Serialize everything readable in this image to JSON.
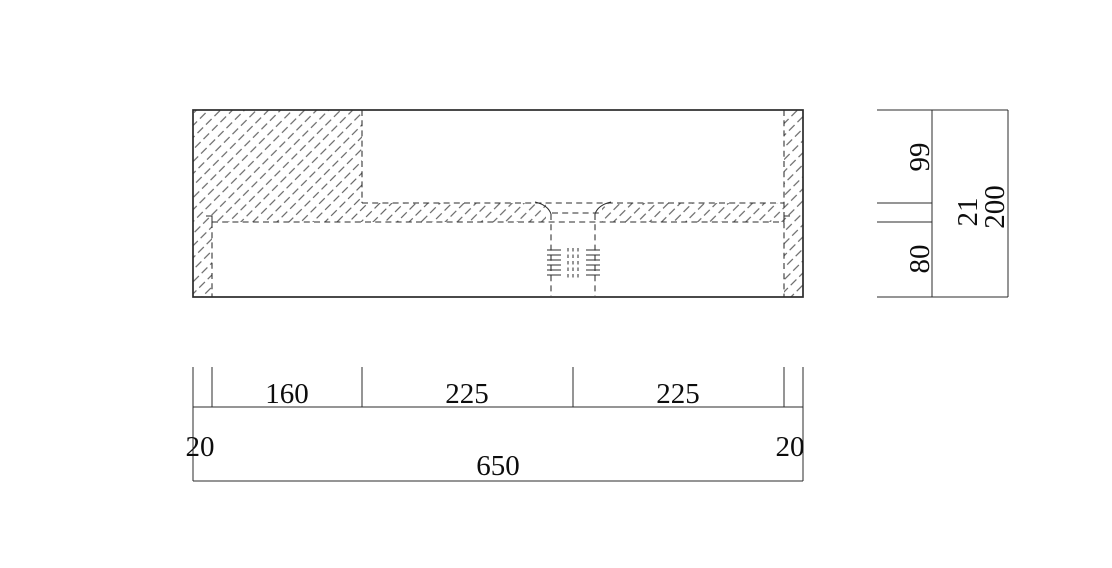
{
  "colors": {
    "background": "#ffffff",
    "line": "#2b2b2b",
    "hatch": "#4a4a4a",
    "text": "#0d0d0d"
  },
  "section_dims": {
    "upper_height": "99",
    "slab_thickness": "21",
    "lower_height": "80",
    "total_height": "200"
  },
  "plan_dims": {
    "left_edge": "20",
    "solid_section": "160",
    "bowl_front": "225",
    "bowl_back": "225",
    "right_edge": "20",
    "total_width": "650"
  }
}
